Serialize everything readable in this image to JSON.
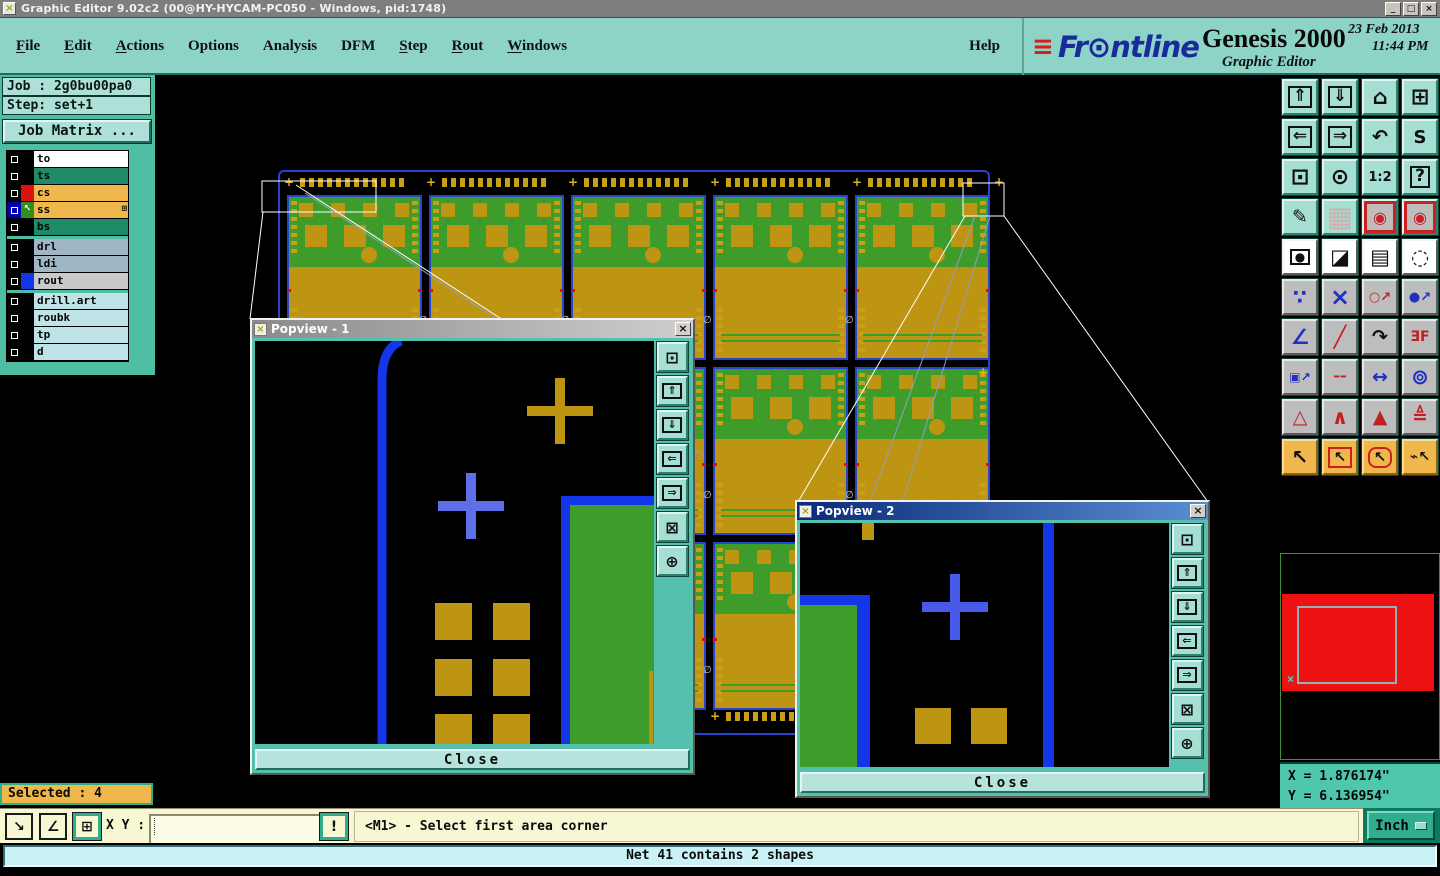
{
  "window": {
    "title": "Graphic Editor 9.02c2 (00@HY-HYCAM-PC050 - Windows, pid:1748)",
    "app_icon_glyph": "×",
    "controls": [
      {
        "name": "minimize",
        "glyph": "_"
      },
      {
        "name": "restore",
        "glyph": "□"
      },
      {
        "name": "close",
        "glyph": "×"
      }
    ]
  },
  "menu": {
    "items": [
      {
        "label": "File",
        "mnemonic": true
      },
      {
        "label": "Edit",
        "mnemonic": true
      },
      {
        "label": "Actions",
        "mnemonic": true
      },
      {
        "label": "Options",
        "mnemonic": false
      },
      {
        "label": "Analysis",
        "mnemonic": false
      },
      {
        "label": "DFM",
        "mnemonic": false
      },
      {
        "label": "Step",
        "mnemonic": true
      },
      {
        "label": "Rout",
        "mnemonic": true
      },
      {
        "label": "Windows",
        "mnemonic": true
      }
    ],
    "help_label": "Help"
  },
  "brand": {
    "speed_lines": "≡",
    "logo_text": "Fr⊙ntline",
    "product": "Genesis 2000",
    "date": "23 Feb 2013",
    "time": "11:44 PM",
    "subtitle": "Graphic Editor"
  },
  "sidebar": {
    "job_label": "Job : 2g0bu00pa0",
    "step_label": "Step: set+1",
    "job_matrix_label": "Job Matrix ...",
    "selected_label": "Selected : 4",
    "layer_groups": [
      [
        {
          "label": "to",
          "bg": "#ffffff"
        },
        {
          "label": "ts",
          "bg": "#1f8a68"
        },
        {
          "label": "cs",
          "bg": "#f0b84c",
          "swatch": "#e01010"
        },
        {
          "label": "ss",
          "bg": "#f0b84c",
          "swatch": "#2f8f1f",
          "arrow": "↖",
          "active": true,
          "grid_mark": "⊞"
        },
        {
          "label": "bs",
          "bg": "#1f8a68"
        }
      ],
      [
        {
          "label": "drl",
          "bg": "#9fb6c4"
        },
        {
          "label": "ldi",
          "bg": "#9fb6c4"
        },
        {
          "label": "rout",
          "bg": "#c9c9c9",
          "swatch": "#1535e8"
        }
      ],
      [
        {
          "label": "drill.art",
          "bg": "#bfe4e8"
        },
        {
          "label": "roubk",
          "bg": "#bfe4e8"
        },
        {
          "label": "tp",
          "bg": "#bfe4e8"
        },
        {
          "label": "d",
          "bg": "#bfe4e8"
        }
      ]
    ]
  },
  "toolbar": {
    "buttons": [
      {
        "name": "copy-screen",
        "glyph": "⇑",
        "style": "teal",
        "glyph_style": "boxed"
      },
      {
        "name": "screen-capture",
        "glyph": "⇓",
        "style": "teal",
        "glyph_style": "boxed"
      },
      {
        "name": "home-view",
        "glyph": "⌂",
        "style": "teal",
        "size": 21
      },
      {
        "name": "split-view-xy",
        "glyph": "⊞",
        "style": "teal",
        "size": 22
      },
      {
        "name": "pan-left",
        "glyph": "⇐",
        "style": "teal",
        "glyph_style": "boxed"
      },
      {
        "name": "pan-right",
        "glyph": "⇒",
        "style": "teal",
        "glyph_style": "boxed"
      },
      {
        "name": "previous-view",
        "glyph": "↶",
        "style": "teal",
        "size": 19
      },
      {
        "name": "profile-path",
        "glyph": "S",
        "style": "teal",
        "size": 18
      },
      {
        "name": "zoom-fit",
        "glyph": "⊡",
        "style": "teal",
        "size": 22
      },
      {
        "name": "zoom-center",
        "glyph": "⊙",
        "style": "teal",
        "size": 22
      },
      {
        "name": "zoom-ratio-1-2",
        "glyph": "1:2",
        "style": "teal",
        "size": 13
      },
      {
        "name": "context-help",
        "glyph": "?",
        "style": "teal",
        "glyph_style": "boxed"
      },
      {
        "name": "edit-tools",
        "glyph": "✎",
        "style": "teal",
        "size": 19
      },
      {
        "name": "grid-toggle",
        "glyph": "▦",
        "style": "teal",
        "color": "#cfb0b0",
        "size": 27
      },
      {
        "name": "cross-probe",
        "glyph": "◉",
        "style": "red-frame",
        "color": "#cc2020",
        "size": 16
      },
      {
        "name": "net-highlight",
        "glyph": "◉",
        "style": "red-frame",
        "color": "#cc2020",
        "size": 16
      },
      {
        "name": "select-feature",
        "glyph": "●",
        "style": "white",
        "glyph_style": "boxed",
        "size": 12
      },
      {
        "name": "layer-compare",
        "glyph": "◪",
        "style": "white",
        "size": 21
      },
      {
        "name": "measure-ruler",
        "glyph": "▤",
        "style": "white",
        "size": 21
      },
      {
        "name": "pad-capture",
        "glyph": "◌",
        "style": "white",
        "size": 21
      },
      {
        "name": "net-endpoints",
        "glyph": "∵",
        "style": "gray",
        "color": "#2030c0",
        "size": 20
      },
      {
        "name": "delete-feature",
        "glyph": "×",
        "style": "gray",
        "color": "#2030c0",
        "size": 24
      },
      {
        "name": "move-point",
        "glyph": "○↗",
        "style": "gray",
        "color": "#c02020",
        "size": 13
      },
      {
        "name": "copy-point",
        "glyph": "●↗",
        "style": "gray",
        "color": "#2030c0",
        "size": 13
      },
      {
        "name": "measure-angle",
        "glyph": "∠",
        "style": "gray",
        "color": "#2030c0",
        "size": 21
      },
      {
        "name": "draw-slope",
        "glyph": "╱",
        "style": "gray",
        "color": "#c02020",
        "size": 21
      },
      {
        "name": "rotate-feature",
        "glyph": "↷",
        "style": "gray",
        "size": 19
      },
      {
        "name": "mirror-feature",
        "glyph": "ƎF",
        "style": "gray",
        "color": "#c02020",
        "size": 14
      },
      {
        "name": "copy-to-layer",
        "glyph": "▣↗",
        "style": "gray",
        "color": "#2030c0",
        "size": 12
      },
      {
        "name": "line-style",
        "glyph": "╌",
        "style": "gray",
        "color": "#c02020",
        "size": 22
      },
      {
        "name": "measure-width",
        "glyph": "↔",
        "style": "gray",
        "color": "#2030c0",
        "size": 19
      },
      {
        "name": "surface-ops",
        "glyph": "⊚",
        "style": "gray",
        "color": "#2030c0",
        "size": 21
      },
      {
        "name": "add-triangle-outline",
        "glyph": "△",
        "style": "gray",
        "color": "#c02020",
        "size": 19
      },
      {
        "name": "add-chevron",
        "glyph": "∧",
        "style": "gray",
        "color": "#c02020",
        "size": 20
      },
      {
        "name": "add-triangle-filled",
        "glyph": "▲",
        "style": "gray",
        "color": "#c02020",
        "size": 19
      },
      {
        "name": "add-triangle-axis",
        "glyph": "≜",
        "style": "gray",
        "color": "#c02020",
        "size": 19
      },
      {
        "name": "select-single",
        "glyph": "↖",
        "style": "amber",
        "size": 20
      },
      {
        "name": "select-rectangle",
        "glyph": "↖",
        "style": "amber",
        "glyph_style": "red-box",
        "size": 15
      },
      {
        "name": "select-polygon",
        "glyph": "↖",
        "style": "amber",
        "glyph_style": "red-round",
        "size": 15
      },
      {
        "name": "select-net",
        "glyph": "⌁↖",
        "style": "amber",
        "size": 14
      }
    ]
  },
  "popviews": [
    {
      "title": "Popview - 1",
      "close_label": "Close",
      "active": false
    },
    {
      "title": "Popview - 2",
      "close_label": "Close",
      "active": true
    }
  ],
  "popview_buttons": [
    {
      "name": "detach-view",
      "glyph": "⊡"
    },
    {
      "name": "pan-up",
      "glyph": "⇑",
      "boxed": true
    },
    {
      "name": "pan-down",
      "glyph": "⇓",
      "boxed": true
    },
    {
      "name": "pan-left",
      "glyph": "⇐",
      "boxed": true
    },
    {
      "name": "pan-right",
      "glyph": "⇒",
      "boxed": true
    },
    {
      "name": "zoom-fit",
      "glyph": "⊠"
    },
    {
      "name": "zoom-center",
      "glyph": "⊕"
    }
  ],
  "statusbar": {
    "tools": [
      {
        "name": "snap-diagonal",
        "glyph": "↘",
        "active": false
      },
      {
        "name": "snap-angle",
        "glyph": "∠",
        "active": false
      },
      {
        "name": "grid-snap",
        "glyph": "⊞",
        "active": true
      }
    ],
    "xy_label": "X Y :",
    "input_value": "",
    "alert_glyph": "!",
    "prompt": "<M1> - Select first area corner",
    "units_label": "Inch"
  },
  "coords": {
    "x": "X = 1.876174\"",
    "y": "Y = 6.136954\""
  },
  "message_bar": "Net 41 contains 2 shapes",
  "colors": {
    "chrome_teal": "#8dd4c6",
    "sidebar_teal": "#4fbda1",
    "button_face": "#a5ded2",
    "amber": "#f0b84c",
    "pcb_green": "#3e9d2a",
    "pcb_gold": "#bd9512",
    "panel_blue": "#2743d0",
    "popview_blue": "#1535e8",
    "cross_periwinkle": "#5f6fe8",
    "alarm_red": "#ee1111",
    "status_yellow": "#f7f7d4",
    "message_cyan": "#c9f2f6"
  }
}
